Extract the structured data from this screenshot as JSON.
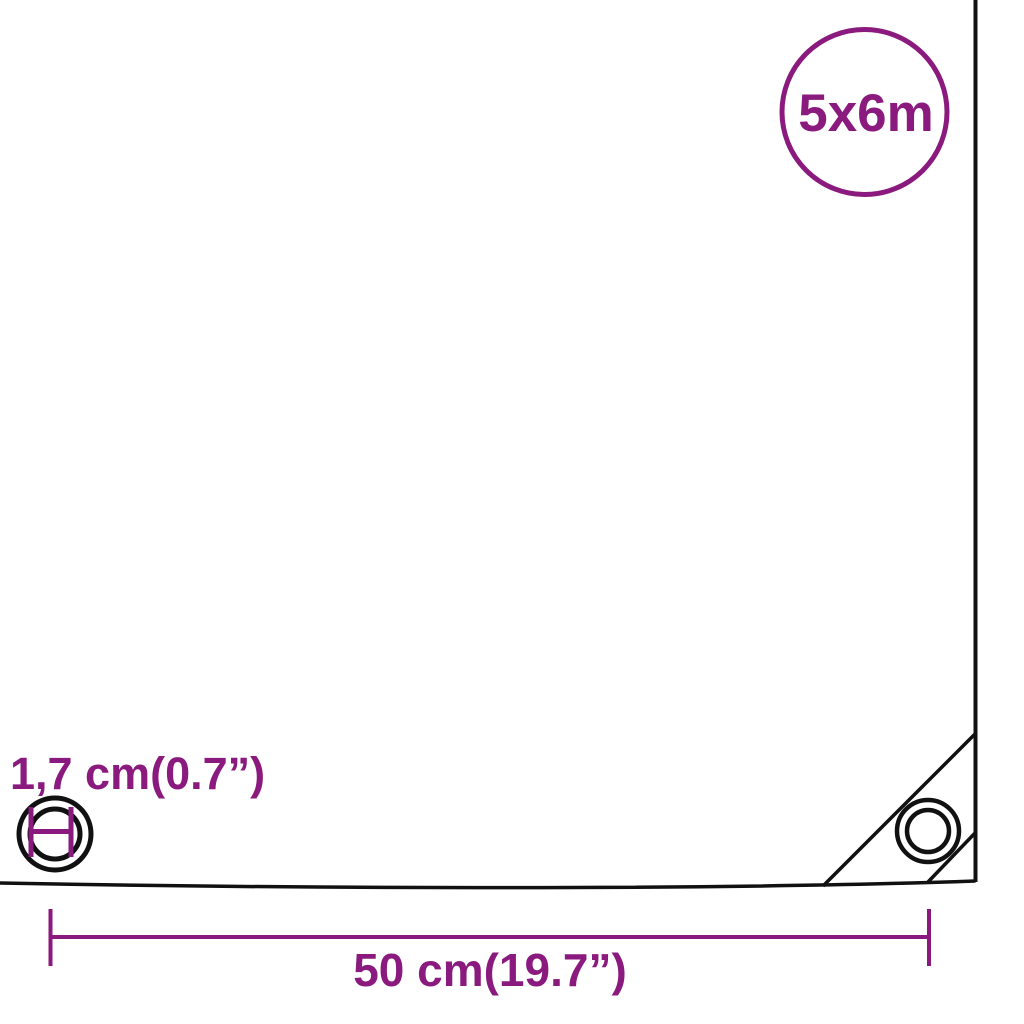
{
  "diagram": {
    "type": "tarpaulin-dimension-diagram",
    "background": "#ffffff"
  },
  "size_badge": {
    "label": "5x6m",
    "color": "#8A1A7E"
  },
  "eyelet_detail": {
    "label": "1,7 cm(0.7”)",
    "measure_color": "#8A1A7E",
    "ring_color": "#111111"
  },
  "corner_dimension": {
    "label": "50 cm(19.7”)",
    "color": "#8A1A7E"
  },
  "tarp": {
    "outline_color": "#111111"
  }
}
